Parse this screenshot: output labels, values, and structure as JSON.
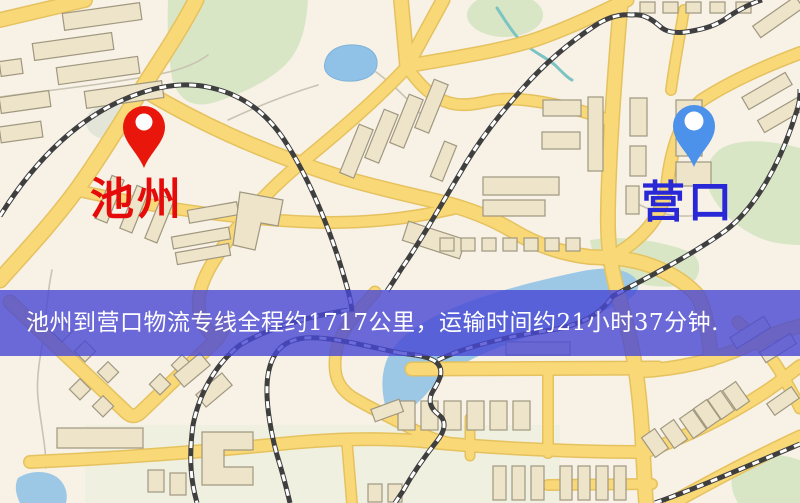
{
  "banner": {
    "text": "池州到营口物流专线全程约1717公里，运输时间约21小时37分钟.",
    "bg_color": "#4747d5",
    "text_color": "#ffffff"
  },
  "origin": {
    "name": "池州",
    "pin_color": "#e9170b",
    "label_color": "#e60b0b"
  },
  "destination": {
    "name": "营口",
    "pin_color": "#4d92ea",
    "label_color": "#2828d7"
  },
  "route_summary": {
    "distance_km": "1717",
    "duration": "21小时37分钟"
  },
  "map_colors": {
    "bg": "#f7f1e6",
    "road": "#f9d878",
    "road_casing": "#e5c25e",
    "building": "#ede4c9",
    "building_outline": "#a09780",
    "green": "#d8e6c6",
    "water": "#90c2e8",
    "railway": "#3f3f3f"
  }
}
